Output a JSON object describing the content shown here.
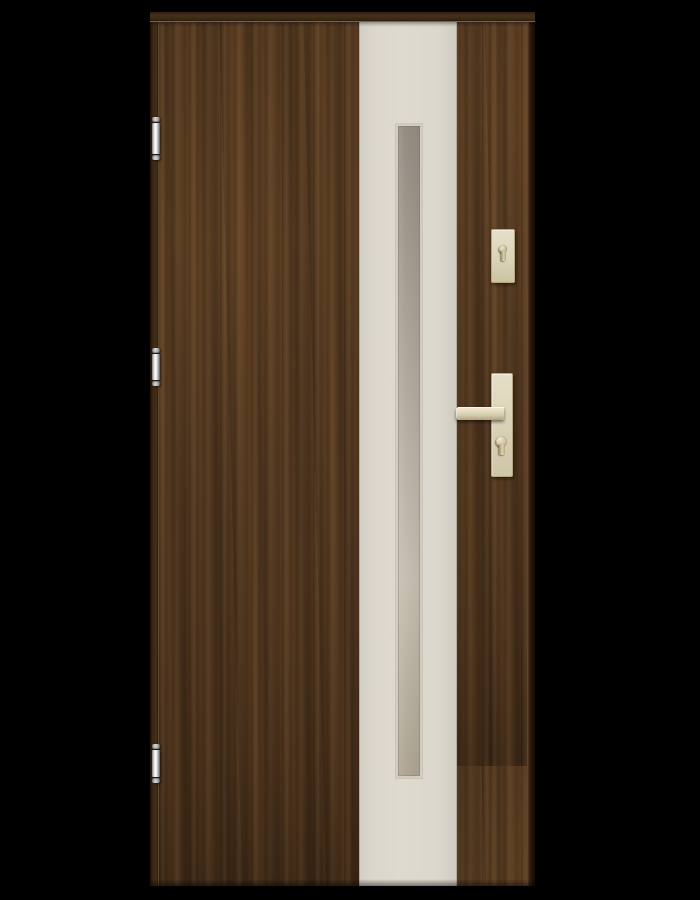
{
  "scene": {
    "subject": "wooden-entrance-door-product-photo",
    "background": "black",
    "door": {
      "finish": "dark-walnut-woodgrain",
      "center_panel": "cream vertical panel with long narrow frosted glazing strip",
      "hardware_finish": "champagne-satin",
      "hardware_parts": [
        "upper-escutcheon-with-keyhole",
        "lever-handle",
        "handle-backplate",
        "euro-cylinder-keyhole"
      ],
      "hinges": {
        "count": 3,
        "finish": "chrome",
        "positions": [
          "top",
          "middle",
          "bottom"
        ]
      }
    }
  },
  "colors": {
    "bg": "#000000",
    "wood-base": "#50361f",
    "wood-light": "#6b4a2a",
    "wood-dark": "#2c1d0e",
    "lintel": "#46301a",
    "panel-cream": "#dbd7cd",
    "glass-rim": "#d2cdc1",
    "glass-dark": "#958c81",
    "glass-mid": "#b7aea2",
    "glass-light": "#c7bfb1",
    "hw-base": "#dcd4b8",
    "hw-light": "#f1ebd6",
    "hw-shadow": "#b0a37f",
    "hw-edge": "#b5a87f",
    "hinge-light": "#ffffff",
    "hinge-mid": "#d6d6d6",
    "hinge-dark": "#6f6f6f"
  }
}
